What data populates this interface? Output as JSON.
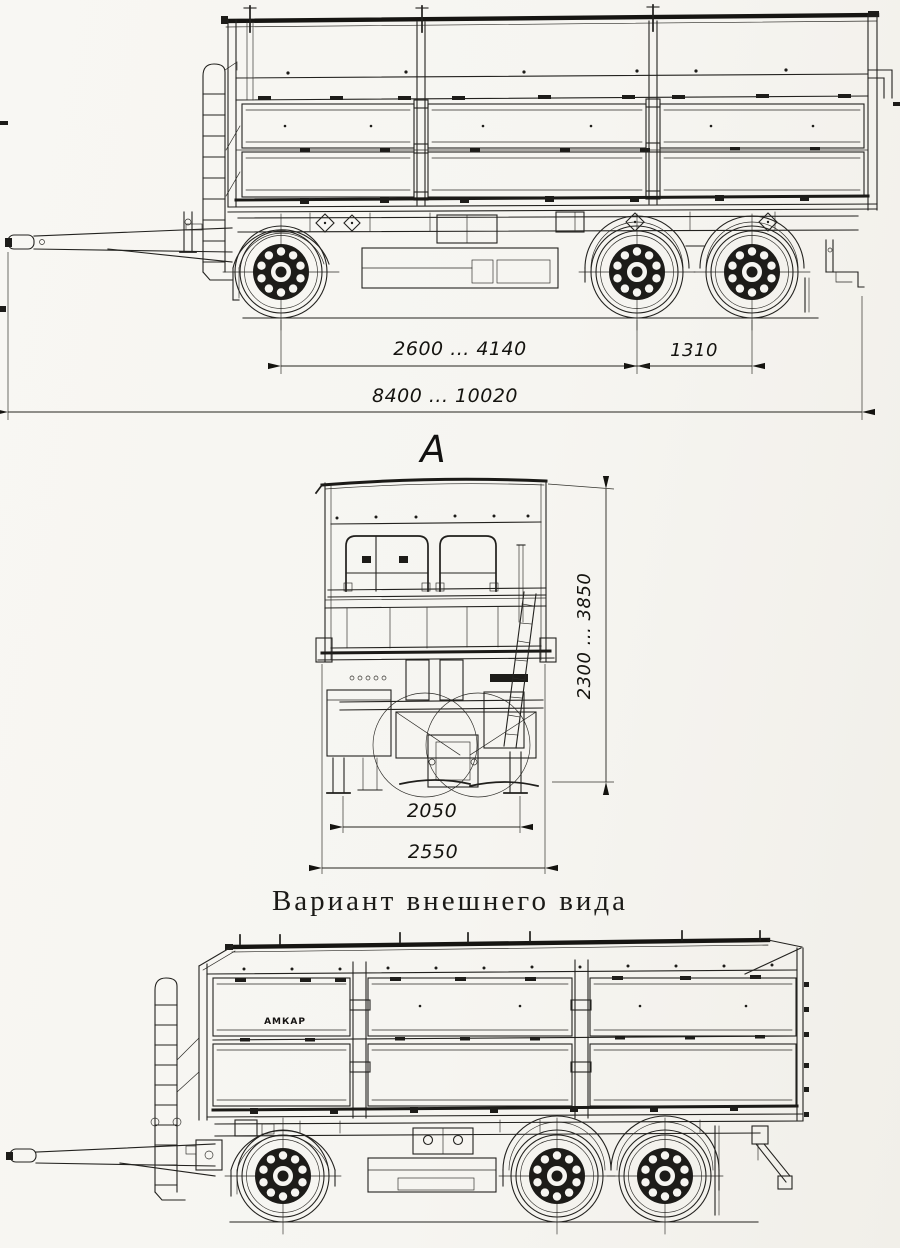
{
  "page": {
    "background": "#f6f5f1",
    "ink": "#23221f",
    "content": "Technical outline drawing of a three-axle drop-side tipper trailer: side view with dimensions, front view A, and exterior-variant side view"
  },
  "side_view": {
    "dim_axle_base": "2600 ... 4140",
    "dim_tandem_spacing": "1310",
    "dim_overall_length": "8400 ... 10020"
  },
  "front_view": {
    "view_label": "А",
    "dim_height": "2300 ... 3850",
    "dim_support_track": "2050",
    "dim_overall_width": "2550"
  },
  "variant_view": {
    "caption": "Вариант внешнего вида",
    "body_logo": "АМКАР"
  }
}
